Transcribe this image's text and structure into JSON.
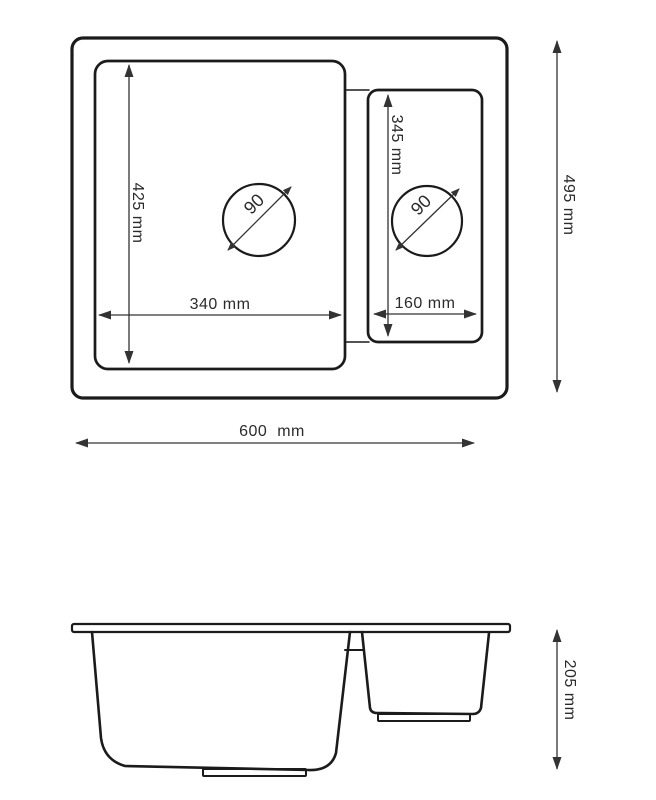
{
  "colors": {
    "line": "#1b1b1b",
    "dimension_line": "#333333",
    "text": "#2b2b2b",
    "background": "#ffffff"
  },
  "top_view": {
    "overall_width": "600  mm",
    "overall_depth": "495 mm",
    "main_bowl": {
      "width": "340 mm",
      "depth": "425 mm",
      "drain_diameter": "90"
    },
    "small_bowl": {
      "width": "160 mm",
      "depth": "345 mm",
      "drain_diameter": "90"
    }
  },
  "side_view": {
    "overall_height": "205 mm"
  }
}
